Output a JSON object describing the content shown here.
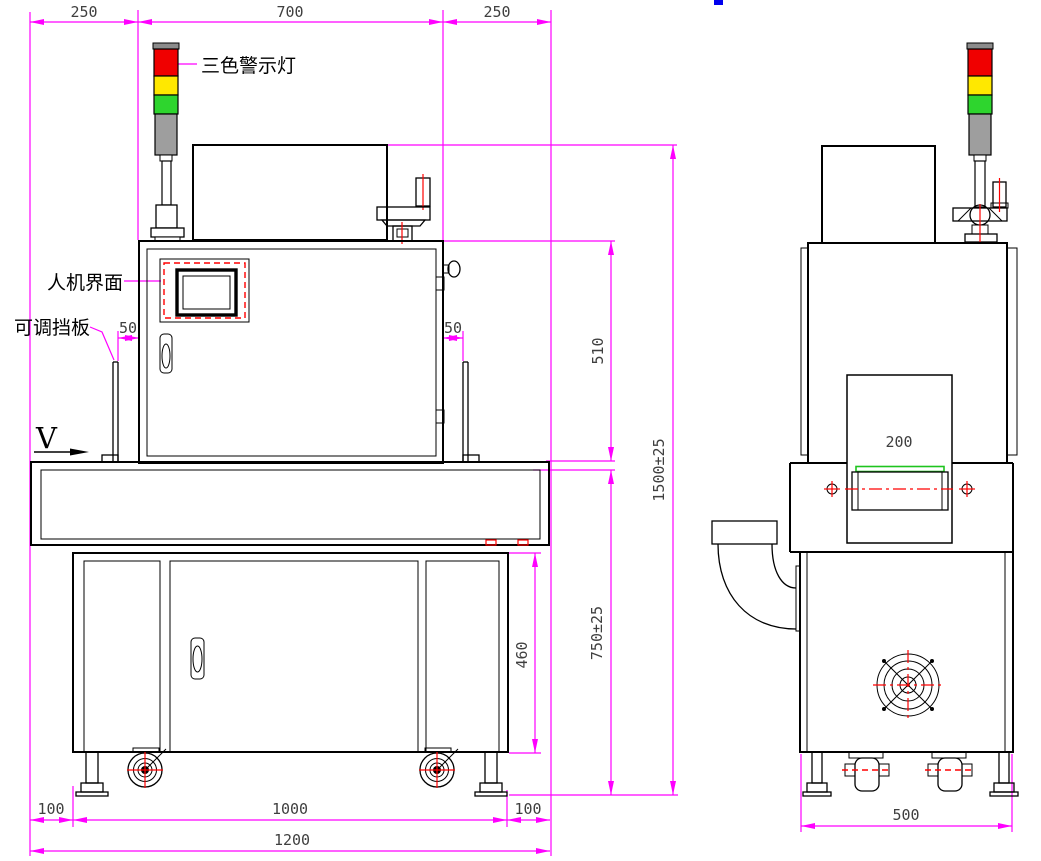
{
  "front_view": {
    "dims": {
      "top_left_margin": "250",
      "top_width": "700",
      "top_right_margin": "250",
      "baffle_gap_left": "50",
      "baffle_gap_right": "50",
      "upper_section_height": "510",
      "total_height": "1500±25",
      "table_height": "750±25",
      "base_cabinet_height": "460",
      "foot_offset_left": "100",
      "feet_spacing": "1000",
      "foot_offset_right": "100",
      "total_width": "1200"
    },
    "labels": {
      "tower_light": "三色警示灯",
      "hmi": "人机界面",
      "adjustable_baffle": "可调挡板",
      "view_marker": "V"
    }
  },
  "side_view": {
    "dims": {
      "belt_width": "200",
      "total_depth": "500"
    }
  },
  "colors": {
    "dimension": "#ff00ff",
    "outline": "#000000",
    "centerline": "#ff0000",
    "belt_green": "#1ec41e",
    "light_red": "#f00000",
    "light_yellow": "#ffe800",
    "light_green": "#2ed52e",
    "light_gray": "#9e9e9e"
  }
}
